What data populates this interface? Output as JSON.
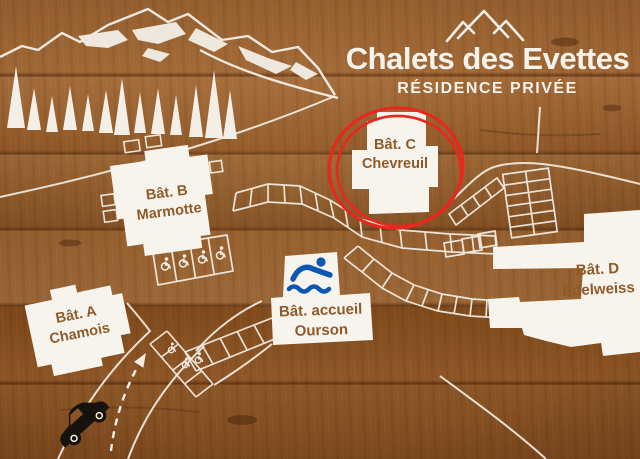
{
  "sign": {
    "title": "Chalets des Evettes",
    "subtitle": "RÉSIDENCE PRIVÉE"
  },
  "buildings": [
    {
      "key": "a",
      "name": "Bât. A",
      "animal": "Chamois",
      "highlighted": false
    },
    {
      "key": "b",
      "name": "Bât. B",
      "animal": "Marmotte",
      "highlighted": false
    },
    {
      "key": "c",
      "name": "Bât. C",
      "animal": "Chevreuil",
      "highlighted": true,
      "highlight_style": "hand-drawn red double circle"
    },
    {
      "key": "d",
      "name": "Bât. D",
      "animal": "Edelweiss",
      "highlighted": false
    },
    {
      "key": "accueil",
      "name": "Bât. accueil",
      "animal": "Ourson",
      "highlighted": false
    }
  ],
  "icons": {
    "logo": "mountain-peaks-icon",
    "pool": "swimmer-icon",
    "accessible_parking": "wheelchair-icon",
    "vehicle": "car-icon",
    "entrance": "dashed-arrow-icon",
    "scenery": [
      "mountain-range",
      "pine-trees"
    ]
  },
  "map_features": {
    "accessible_parking_icon_count": 7,
    "parking_areas": [
      "curved row upper",
      "curved row lower",
      "grid 2x6 upper right",
      "diagonal row with wheelchair",
      "entry road row with wheelchairs",
      "4 accessible spots below Bât. B"
    ]
  },
  "colors": {
    "wood": "#8a5526",
    "paint_white": "#f6f3ec",
    "label_brown": "#8f5a28",
    "highlight_red": "#e8281c",
    "pool_blue": "#0d57b2",
    "car_black": "#17120d"
  }
}
